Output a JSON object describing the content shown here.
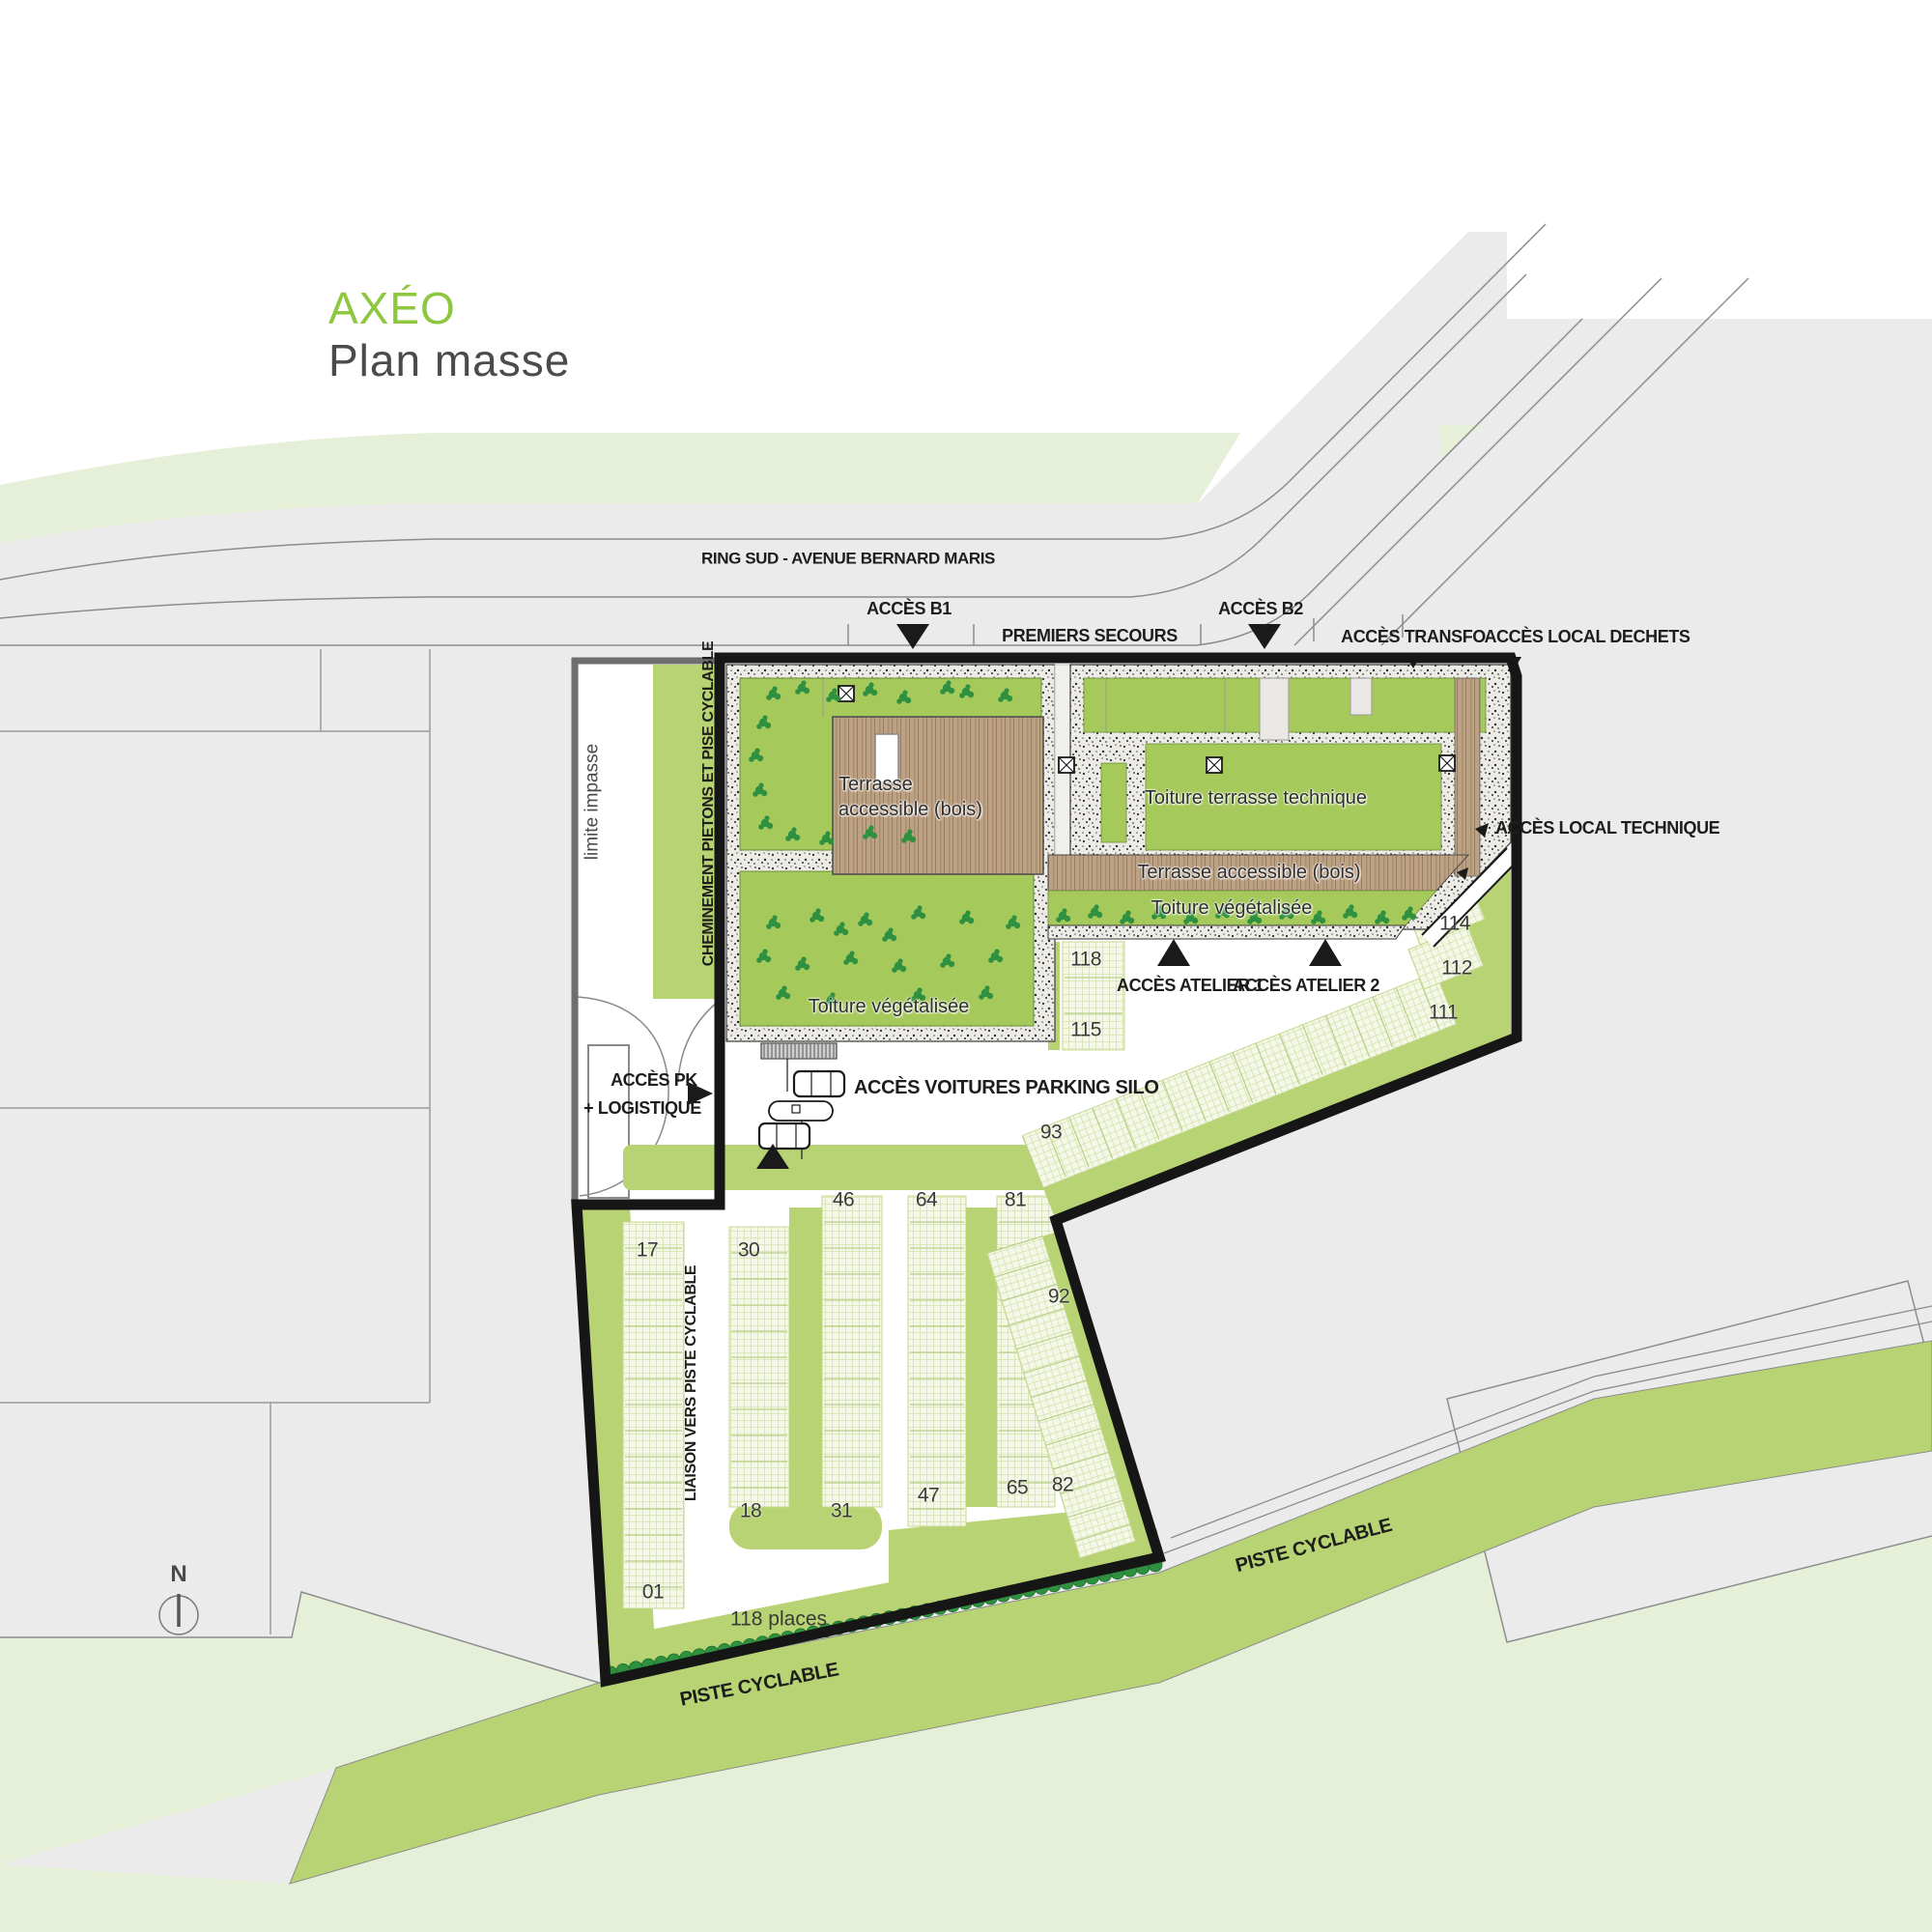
{
  "title": {
    "brand": "AXÉO",
    "subtitle": "Plan masse"
  },
  "roads": {
    "main_road": "RING SUD - AVENUE BERNARD MARIS",
    "bike_path_left": "PISTE CYCLABLE",
    "bike_path_right": "PISTE CYCLABLE"
  },
  "access": {
    "b1": "ACCÈS B1",
    "b2": "ACCÈS B2",
    "first_aid": "PREMIERS SECOURS",
    "transfo": "ACCÈS TRANSFO",
    "waste": "ACCÈS LOCAL DECHETS",
    "technical": "ACCÈS LOCAL TECHNIQUE",
    "workshop1": "ACCÈS ATELIER 1",
    "workshop2": "ACCÈS ATELIER 2",
    "parking_line1": "ACCÈS PK",
    "parking_line2": "+ LOGISTIQUE",
    "cars_silo": "ACCÈS VOITURES PARKING SILO"
  },
  "boundaries": {
    "limit": "limite impasse",
    "pedestrian": "CHEMINEMENT PIETONS ET PISE CYCLABLE",
    "liaison": "LIAISON VERS PISTE CYCLABLE"
  },
  "roofs": {
    "terrace_a": "Terrasse",
    "terrace_a2": "accessible (bois)",
    "technical_roof": "Toiture terrasse technique",
    "terrace_b": "Terrasse accessible (bois)",
    "green_roof_b": "Toiture végétalisée",
    "green_roof_a": "Toiture végétalisée"
  },
  "parking": {
    "capacity": "118 places",
    "spots": {
      "s118": "118",
      "s115": "115",
      "s114": "114",
      "s112": "112",
      "s111": "111",
      "s93": "93",
      "s92": "92",
      "s46": "46",
      "s64": "64",
      "s81": "81",
      "s17": "17",
      "s30": "30",
      "s18": "18",
      "s31": "31",
      "s47": "47",
      "s65": "65",
      "s82": "82",
      "s01": "01"
    }
  },
  "compass": {
    "north": "N"
  },
  "colors": {
    "accent_green": "#8dc63f",
    "roof_green": "#a6c95c",
    "verge_green": "#b8d373",
    "pale_green": "#e6efd7",
    "stall_green": "#f3f7e4",
    "road_gray": "#ebebeb",
    "wood": "#bda184",
    "boundary_black": "#1a1a1a",
    "tree_green": "#2e9147"
  }
}
